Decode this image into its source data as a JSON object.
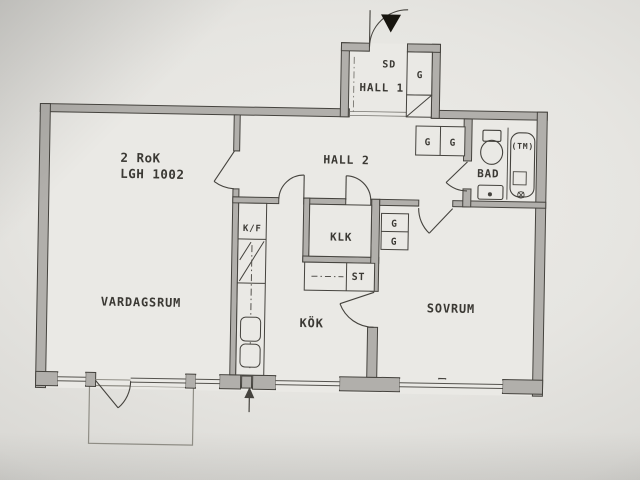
{
  "floorplan": {
    "apartment": {
      "type_label": "2 RoK",
      "id_label": "LGH 1002"
    },
    "rooms": {
      "hall1": "HALL 1",
      "hall2": "HALL 2",
      "living": "VARDAGSRUM",
      "kitchen": "KÖK",
      "bedroom": "SOVRUM",
      "bath": "BAD",
      "walkin_closet": "KLK"
    },
    "labels": {
      "wardrobe": "G",
      "cleaning_closet": "ST",
      "fridge_freezer": "K/F",
      "washing_machine": "(TM)",
      "entrance_door": "SD"
    },
    "colors": {
      "wall_fill": "#b1afab",
      "line": "#45433e",
      "floor": "#eae9e5",
      "paper": "#e6e5e1"
    }
  }
}
